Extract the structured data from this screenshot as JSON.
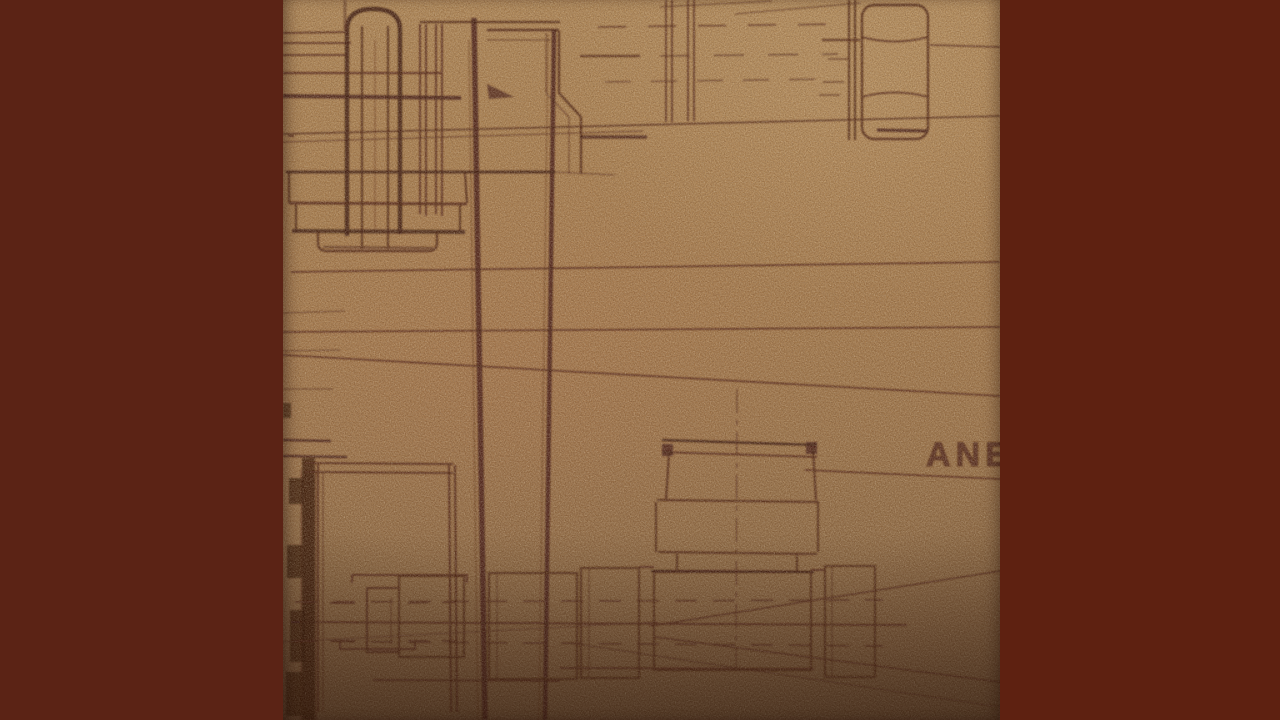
{
  "window": {
    "width_px": 1280,
    "height_px": 720
  },
  "pillarbox": {
    "left_bar_color": "#5b2315",
    "right_bar_color": "#5e2111",
    "photo_left_px": 283,
    "photo_width_px": 717
  },
  "artwork": {
    "kind": "photographed vintage engineering blueprint on kraft paper",
    "paper": {
      "base": "#a67c4e",
      "highlight": "#b28a59",
      "shadow": "#644830"
    },
    "ink": {
      "dark": "#3a140a",
      "medium": "#4a1d10",
      "faint": "#6a3d29"
    },
    "lettering": {
      "text": "ANE",
      "truncated_at_right_edge": true,
      "color": "#4a2015"
    },
    "elements": [
      {
        "name": "stud-and-flange-assembly",
        "area": "top-left"
      },
      {
        "name": "stepped-pipe-elbow",
        "area": "top-center"
      },
      {
        "name": "hex-nut-on-stud",
        "area": "top-right"
      },
      {
        "name": "vertical-pipe-lines",
        "area": "center, full height"
      },
      {
        "name": "long-reference-lines",
        "area": "across middle"
      },
      {
        "name": "valve-bonnet-and-tee-fitting",
        "area": "bottom-center"
      },
      {
        "name": "pipe-couplings",
        "area": "bottom-left, bottom-center, bottom-right"
      },
      {
        "name": "converging-leader-lines",
        "area": "bottom-right"
      },
      {
        "name": "dashed-centerlines",
        "area": "top and bottom bands"
      }
    ]
  }
}
